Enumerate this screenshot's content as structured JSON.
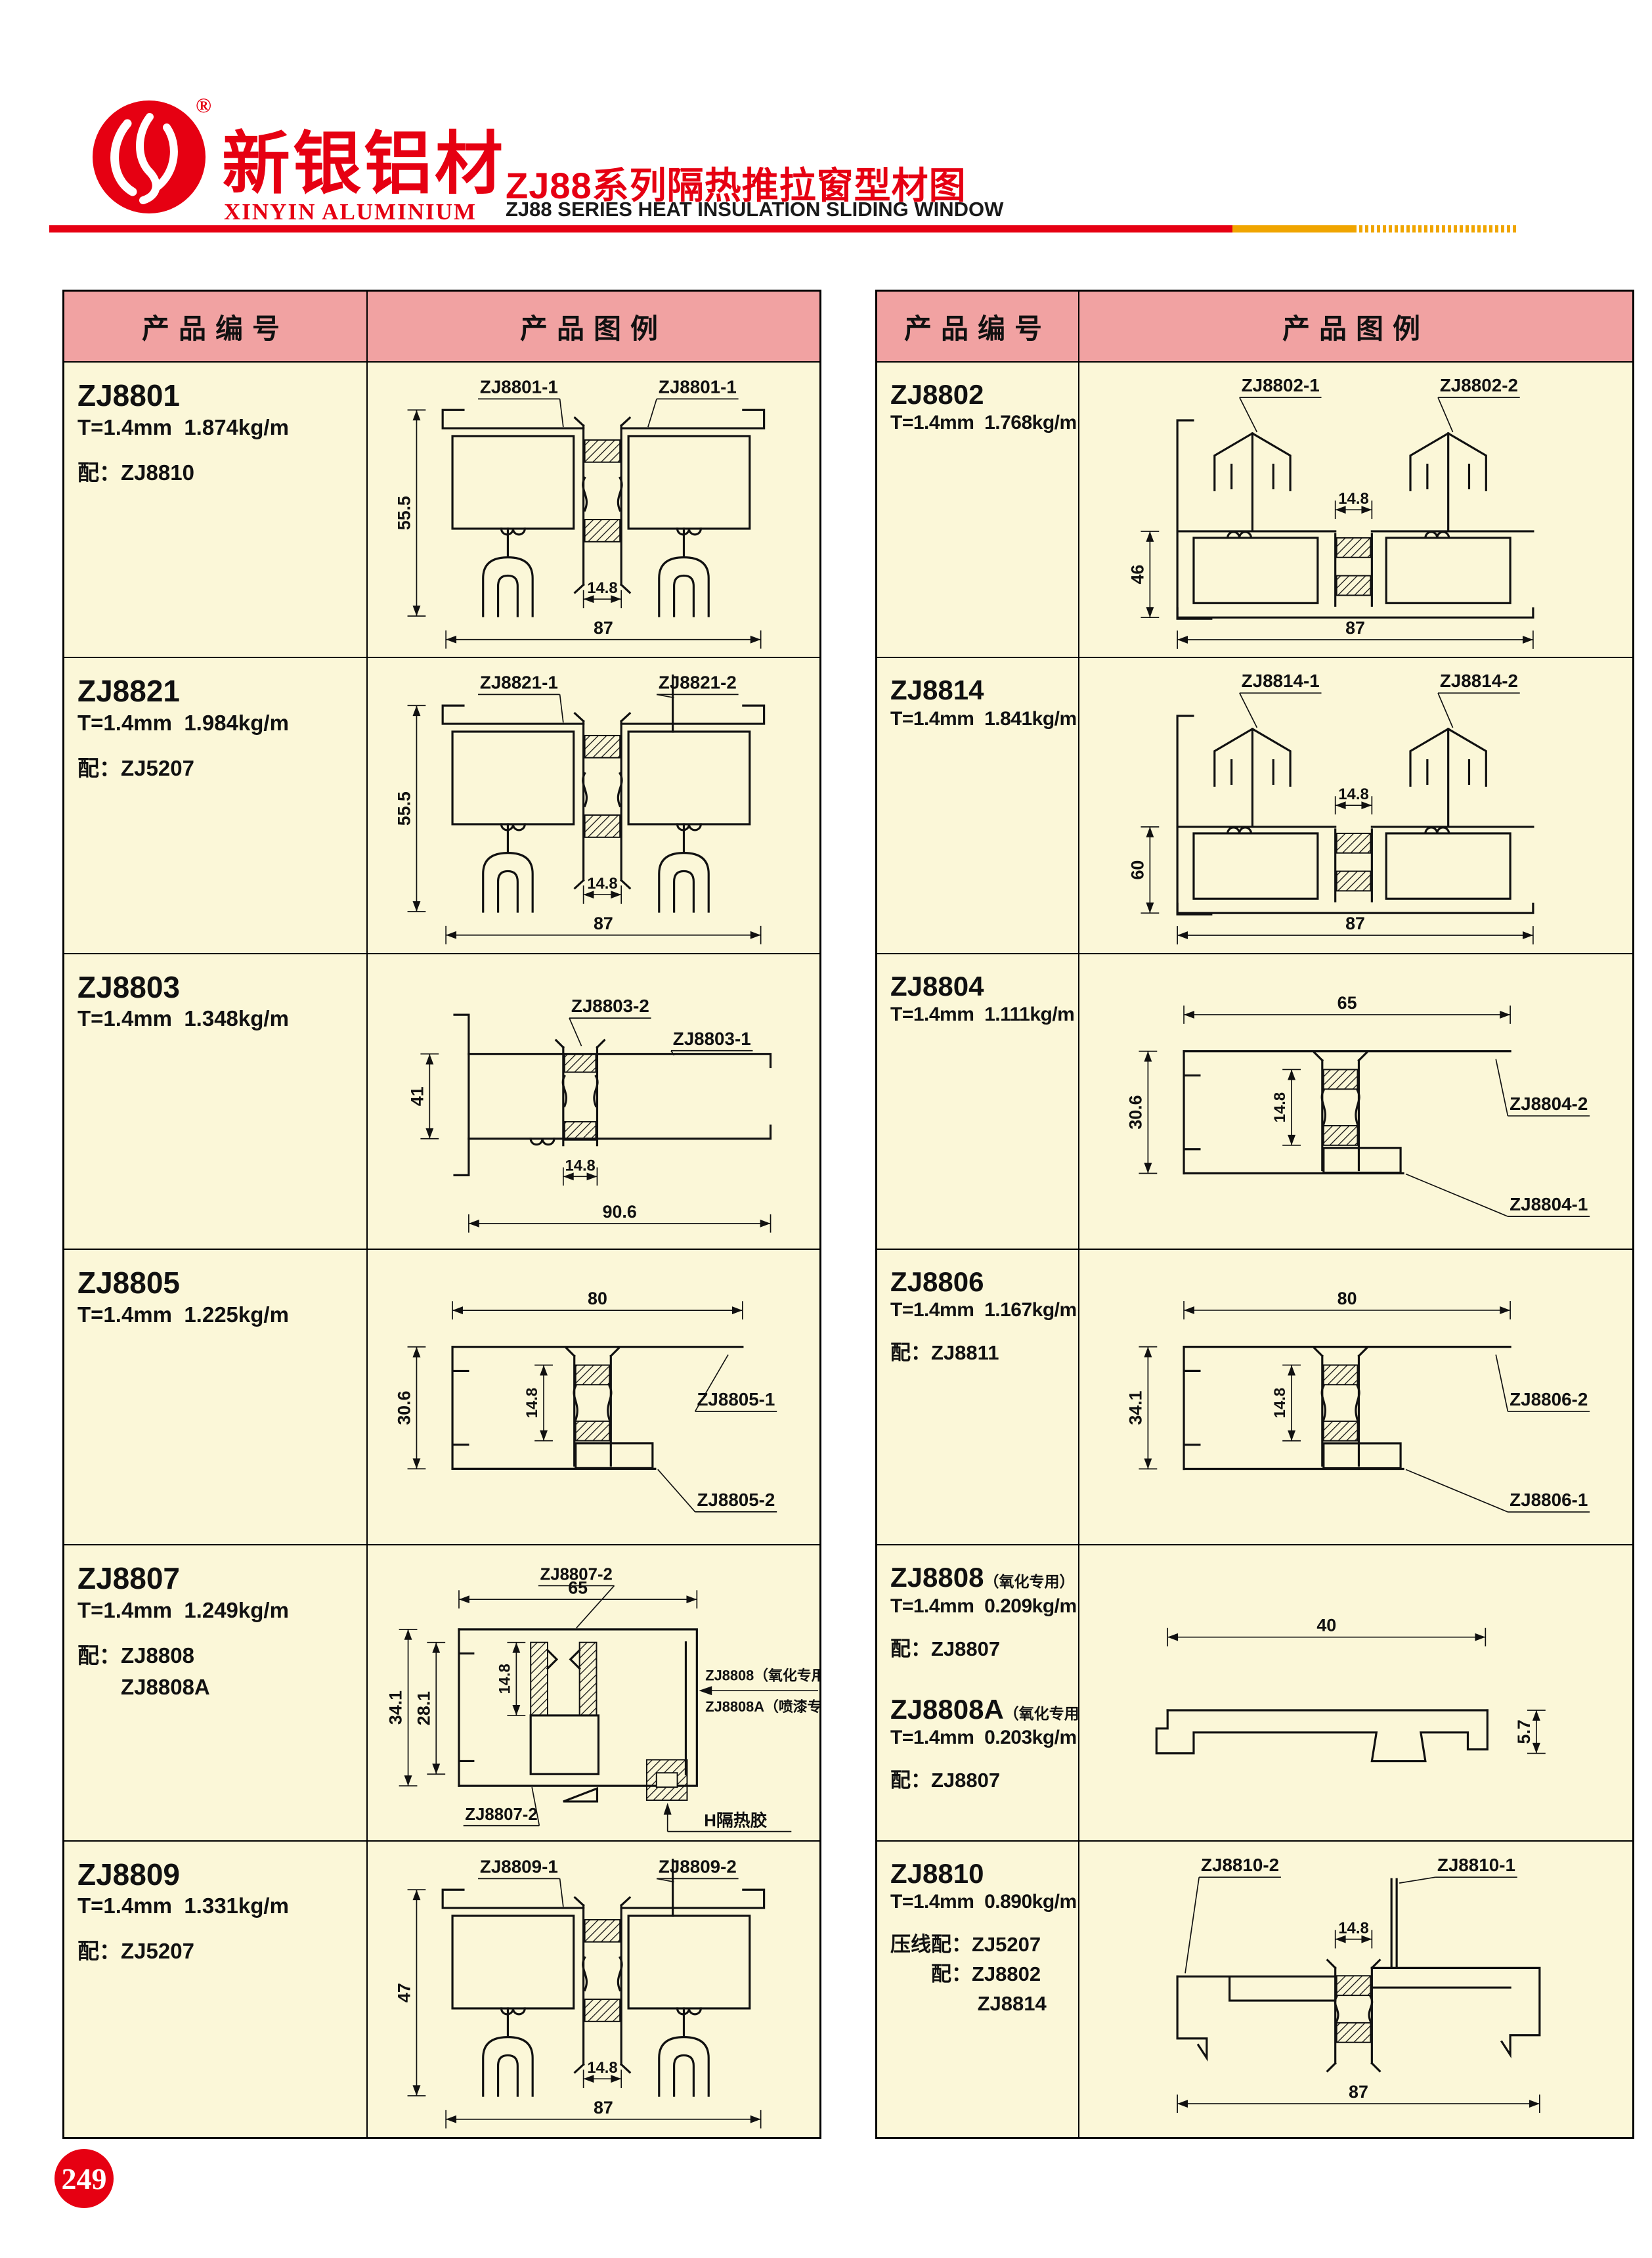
{
  "header": {
    "registered_mark": "®",
    "logo_cn": "新银铝材",
    "logo_en": "XINYIN ALUMINIUM",
    "title_cn": "ZJ88系列隔热推拉窗型材图",
    "title_en": "ZJ88 SERIES HEAT INSULATION SLIDING WINDOW"
  },
  "colors": {
    "brand_red": "#E60012",
    "accent_yellow": "#F0A500",
    "header_pink": "#F1A2A2",
    "cell_cream": "#FBF7D8",
    "ink": "#111111"
  },
  "page_number": "249",
  "column_headers": {
    "code": "产品编号",
    "illustration": "产品图例"
  },
  "tables": [
    {
      "side": "left",
      "rows": [
        {
          "entries": [
            {
              "code": "ZJ8801",
              "suffix": "",
              "spec": "T=1.4mm  1.874kg/m",
              "notes": [
                "配：ZJ8810"
              ]
            }
          ],
          "drawing": {
            "kind": "track",
            "labels": [
              "ZJ8801-1",
              "ZJ8801-1"
            ],
            "riser": false,
            "dims": {
              "left": "55.5",
              "mid": "14.8",
              "bottom": "87"
            }
          }
        },
        {
          "entries": [
            {
              "code": "ZJ8821",
              "suffix": "",
              "spec": "T=1.4mm  1.984kg/m",
              "notes": [
                "配：ZJ5207"
              ]
            }
          ],
          "drawing": {
            "kind": "track",
            "labels": [
              "ZJ8821-1",
              "ZJ8821-2"
            ],
            "riser": true,
            "dims": {
              "left": "55.5",
              "mid": "14.8",
              "bottom": "87"
            }
          }
        },
        {
          "entries": [
            {
              "code": "ZJ8803",
              "suffix": "",
              "spec": "T=1.4mm  1.348kg/m",
              "notes": []
            }
          ],
          "drawing": {
            "kind": "hrail",
            "labels": [
              "ZJ8803-2",
              "ZJ8803-1"
            ],
            "dims": {
              "left": "41",
              "mid": "14.8",
              "bottom": "90.6"
            }
          }
        },
        {
          "entries": [
            {
              "code": "ZJ8805",
              "suffix": "",
              "spec": "T=1.4mm  1.225kg/m",
              "notes": []
            }
          ],
          "drawing": {
            "kind": "sill",
            "labels": [
              "ZJ8805-1",
              "ZJ8805-2"
            ],
            "dims": {
              "top": "80",
              "left": "30.6",
              "mid": "14.8"
            }
          }
        },
        {
          "entries": [
            {
              "code": "ZJ8807",
              "suffix": "",
              "spec": "T=1.4mm  1.249kg/m",
              "notes": [
                "配：ZJ8808",
                "　　ZJ8808A"
              ]
            }
          ],
          "drawing": {
            "kind": "frame",
            "labels": [
              "ZJ8807-2",
              "ZJ8807-2"
            ],
            "dims": {
              "top": "65",
              "left": "34.1",
              "left2": "28.1",
              "mid": "14.8"
            },
            "annotations": [
              "ZJ8808（氧化专用）",
              "ZJ8808A（喷漆专用）",
              "H隔热胶"
            ]
          }
        },
        {
          "entries": [
            {
              "code": "ZJ8809",
              "suffix": "",
              "spec": "T=1.4mm  1.331kg/m",
              "notes": [
                "配：ZJ5207"
              ]
            }
          ],
          "drawing": {
            "kind": "track",
            "labels": [
              "ZJ8809-1",
              "ZJ8809-2"
            ],
            "riser": true,
            "dims": {
              "left": "47",
              "mid": "14.8",
              "bottom": "87"
            }
          }
        }
      ]
    },
    {
      "side": "right",
      "rows": [
        {
          "entries": [
            {
              "code": "ZJ8802",
              "suffix": "",
              "spec": "T=1.4mm  1.768kg/m",
              "notes": []
            }
          ],
          "drawing": {
            "kind": "hook",
            "labels": [
              "ZJ8802-1",
              "ZJ8802-2"
            ],
            "dims": {
              "left": "46",
              "mid": "14.8",
              "bottom": "87"
            }
          }
        },
        {
          "entries": [
            {
              "code": "ZJ8814",
              "suffix": "",
              "spec": "T=1.4mm  1.841kg/m",
              "notes": []
            }
          ],
          "drawing": {
            "kind": "hook",
            "labels": [
              "ZJ8814-1",
              "ZJ8814-2"
            ],
            "dims": {
              "left": "60",
              "mid": "14.8",
              "bottom": "87"
            }
          }
        },
        {
          "entries": [
            {
              "code": "ZJ8804",
              "suffix": "",
              "spec": "T=1.4mm  1.111kg/m",
              "notes": []
            }
          ],
          "drawing": {
            "kind": "sill",
            "labels": [
              "ZJ8804-2",
              "ZJ8804-1"
            ],
            "dims": {
              "top": "65",
              "left": "30.6",
              "mid": "14.8"
            }
          }
        },
        {
          "entries": [
            {
              "code": "ZJ8806",
              "suffix": "",
              "spec": "T=1.4mm  1.167kg/m",
              "notes": [
                "配：ZJ8811"
              ]
            }
          ],
          "drawing": {
            "kind": "sill",
            "labels": [
              "ZJ8806-2",
              "ZJ8806-1"
            ],
            "dims": {
              "top": "80",
              "left": "34.1",
              "mid": "14.8"
            }
          }
        },
        {
          "entries": [
            {
              "code": "ZJ8808",
              "suffix": "（氧化专用）",
              "spec": "T=1.4mm  0.209kg/m",
              "notes": [
                "配：ZJ8807"
              ]
            },
            {
              "code": "ZJ8808A",
              "suffix": "（氧化专用）",
              "spec": "T=1.4mm  0.203kg/m",
              "notes": [
                "配：ZJ8807"
              ]
            }
          ],
          "drawing": {
            "kind": "flatbar",
            "labels": [],
            "dims": {
              "top": "40",
              "right": "5.7"
            }
          }
        },
        {
          "entries": [
            {
              "code": "ZJ8810",
              "suffix": "",
              "spec": "T=1.4mm  0.890kg/m",
              "notes": [
                "压线配：ZJ5207",
                "　　配：ZJ8802",
                "　　　　 ZJ8814"
              ]
            }
          ],
          "drawing": {
            "kind": "interlock",
            "labels": [
              "ZJ8810-2",
              "ZJ8810-1"
            ],
            "dims": {
              "mid": "14.8",
              "bottom": "87"
            }
          }
        }
      ]
    }
  ]
}
